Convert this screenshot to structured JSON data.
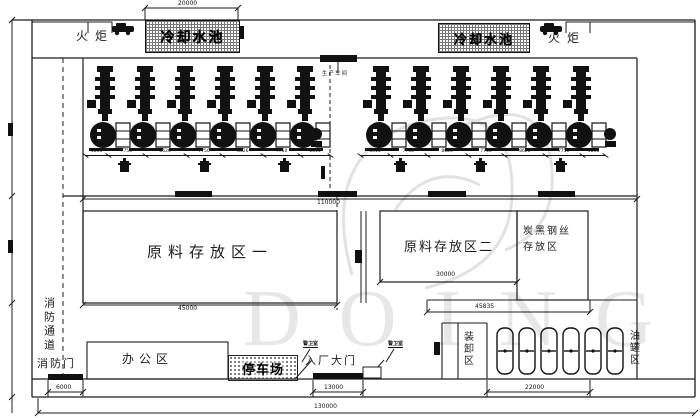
{
  "watermark": {
    "text": "DOING"
  },
  "areas": {
    "flare_left": "火炬",
    "flare_right": "火炬",
    "pool_left": "冷却水池",
    "pool_right": "冷却水池",
    "workshop": "生产车间",
    "storage1": "原料存放区一",
    "storage2": "原料存放区二",
    "carbon_line1": "炭黑钢丝",
    "carbon_line2": "存放区",
    "fire_lane": "消防通道",
    "fire_door": "消防门",
    "office": "办公区",
    "parking": "停车场",
    "gate": "入厂大门",
    "guard_left": "警卫室",
    "guard_right": "警卫室",
    "loading": "装卸区",
    "tank_area": "油罐区"
  },
  "dims": {
    "pool_width": "20000",
    "workshop_width": "110000",
    "storage1_width": "45000",
    "storage2_width": "30000",
    "right_width": "45835",
    "fire_door_width": "6000",
    "gate_width": "13000",
    "tank_width": "22000",
    "total_width": "130000",
    "bank1": [
      "4836",
      "7750",
      "8626",
      "7750",
      "8626",
      "7750",
      "6315"
    ],
    "bank2": [
      "6315",
      "7750",
      "8626",
      "7750",
      "8626",
      "7750",
      "4836"
    ]
  },
  "colors": {
    "line": "#1c1c1c",
    "watermark": "#e5e5e5"
  }
}
